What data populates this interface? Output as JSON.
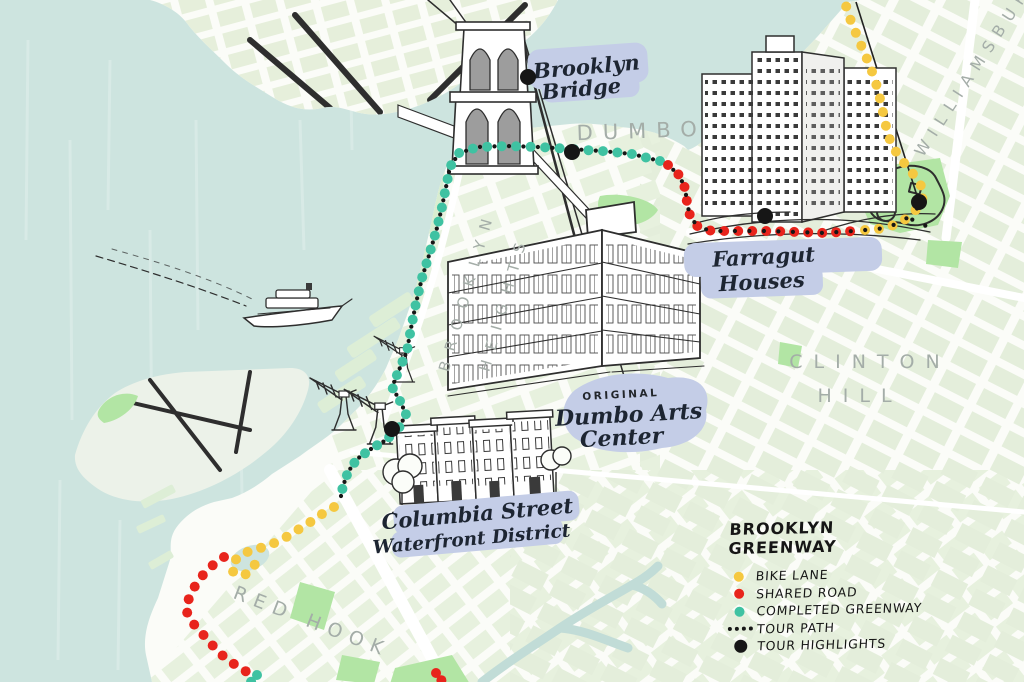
{
  "legend": {
    "title": "BROOKLYN GREENWAY",
    "items": [
      {
        "id": "bike-lane",
        "label": "BIKE LANE",
        "color": "#f5c840",
        "marker": "dot"
      },
      {
        "id": "shared-road",
        "label": "SHARED ROAD",
        "color": "#e8241c",
        "marker": "dot"
      },
      {
        "id": "completed-greenway",
        "label": "COMPLETED GREENWAY",
        "color": "#3fc2a2",
        "marker": "dot"
      },
      {
        "id": "tour-path",
        "label": "TOUR PATH",
        "color": "#161616",
        "marker": "small-dots"
      },
      {
        "id": "tour-highlights",
        "label": "TOUR HIGHLIGHTS",
        "color": "#161616",
        "marker": "large-dot"
      }
    ]
  },
  "labels": {
    "brooklyn_bridge": {
      "line1": "Brooklyn",
      "line2": "Bridge"
    },
    "farragut": {
      "line1": "Farragut",
      "line2": "Houses"
    },
    "dumbo_arts": {
      "kicker": "ORIGINAL",
      "line1": "Dumbo Arts",
      "line2": "Center"
    },
    "columbia": {
      "line1": "Columbia Street",
      "line2": "Waterfront District"
    },
    "neighborhoods": {
      "dumbo": "DUMBO",
      "brooklyn_heights_1": "BROOKLYN",
      "brooklyn_heights_2": "HEIGHTS",
      "clinton_hill_1": "CLINTON",
      "clinton_hill_2": "HILL",
      "red_hook": "RED HOOK",
      "williamsburg": "WILLIAMSBURG"
    }
  },
  "map": {
    "colors": {
      "water": "#cde4df",
      "land": "#fbfcf8",
      "block": "#e6efdb",
      "park": "#b2e5a4",
      "label_blob": "#c4cde7",
      "ink": "#2e2e2e",
      "gray_label": "#a4ada8",
      "canal": "#c1dcd7"
    },
    "routes": [
      {
        "id": "completed-greenway-main",
        "color_ref": "completed-greenway",
        "r": 5,
        "spacing": 14.5,
        "points": [
          [
            660,
            161
          ],
          [
            632,
            154
          ],
          [
            602,
            151
          ],
          [
            570,
            149
          ],
          [
            538,
            147
          ],
          [
            506,
            146
          ],
          [
            478,
            147
          ],
          [
            459,
            153
          ],
          [
            450,
            167
          ],
          [
            446,
            187
          ],
          [
            442,
            207
          ],
          [
            437,
            228
          ],
          [
            430,
            252
          ],
          [
            422,
            278
          ],
          [
            416,
            303
          ],
          [
            411,
            328
          ],
          [
            407,
            351
          ],
          [
            399,
            370
          ],
          [
            392,
            387
          ],
          [
            400,
            401
          ],
          [
            406,
            414
          ],
          [
            399,
            428
          ],
          [
            386,
            440
          ],
          [
            371,
            449
          ],
          [
            357,
            459
          ],
          [
            348,
            472
          ],
          [
            343,
            486
          ],
          [
            340,
            501
          ]
        ]
      },
      {
        "id": "bike-lane-columbia",
        "color_ref": "bike-lane",
        "r": 5,
        "spacing": 14,
        "points": [
          [
            334,
            507
          ],
          [
            322,
            514
          ],
          [
            309,
            523
          ],
          [
            296,
            531
          ],
          [
            283,
            539
          ],
          [
            270,
            545
          ],
          [
            257,
            549
          ],
          [
            244,
            553
          ],
          [
            234,
            561
          ],
          [
            232,
            571
          ],
          [
            241,
            576
          ],
          [
            251,
            572
          ],
          [
            256,
            562
          ],
          [
            250,
            553
          ]
        ]
      },
      {
        "id": "shared-road-redhook",
        "color_ref": "shared-road",
        "r": 5,
        "spacing": 14,
        "points": [
          [
            224,
            557
          ],
          [
            213,
            565
          ],
          [
            203,
            575
          ],
          [
            195,
            586
          ],
          [
            189,
            598
          ],
          [
            186,
            610
          ],
          [
            191,
            621
          ],
          [
            199,
            630
          ],
          [
            207,
            639
          ],
          [
            214,
            647
          ],
          [
            222,
            655
          ],
          [
            231,
            662
          ],
          [
            240,
            668
          ],
          [
            249,
            673
          ]
        ]
      },
      {
        "id": "completed-greenway-tail",
        "color_ref": "completed-greenway",
        "r": 5,
        "spacing": 9,
        "points": [
          [
            257,
            675
          ],
          [
            250,
            683
          ]
        ]
      },
      {
        "id": "shared-road-farragut",
        "color_ref": "shared-road",
        "r": 5,
        "spacing": 14,
        "points": [
          [
            668,
            165
          ],
          [
            679,
            175
          ],
          [
            685,
            188
          ],
          [
            687,
            202
          ],
          [
            690,
            216
          ],
          [
            698,
            227
          ],
          [
            712,
            231
          ],
          [
            740,
            231
          ],
          [
            768,
            231
          ],
          [
            796,
            232
          ],
          [
            824,
            233
          ],
          [
            853,
            231
          ]
        ]
      },
      {
        "id": "bike-lane-navy-yard",
        "color_ref": "bike-lane",
        "r": 5,
        "spacing": 14,
        "points": [
          [
            865,
            230
          ],
          [
            878,
            229
          ],
          [
            891,
            226
          ],
          [
            903,
            221
          ],
          [
            913,
            213
          ],
          [
            921,
            204
          ],
          [
            924,
            192
          ],
          [
            918,
            180
          ],
          [
            909,
            169
          ],
          [
            900,
            158
          ],
          [
            893,
            147
          ],
          [
            888,
            135
          ],
          [
            885,
            122
          ],
          [
            882,
            108
          ],
          [
            879,
            94
          ],
          [
            875,
            80
          ],
          [
            870,
            66
          ],
          [
            864,
            52
          ],
          [
            858,
            38
          ],
          [
            852,
            24
          ],
          [
            847,
            10
          ],
          [
            844,
            -3
          ]
        ]
      },
      {
        "id": "shared-road-gowanus",
        "color_ref": "shared-road",
        "r": 5,
        "spacing": 9,
        "points": [
          [
            436,
            673
          ],
          [
            442,
            681
          ]
        ]
      }
    ],
    "tour_path": {
      "r": 2.1,
      "spacing": 14.5,
      "offset": 7.2,
      "color": "#161616",
      "segments": [
        [
          [
            660,
            161
          ],
          [
            632,
            154
          ],
          [
            602,
            151
          ],
          [
            570,
            149
          ],
          [
            538,
            147
          ],
          [
            506,
            146
          ],
          [
            478,
            147
          ],
          [
            459,
            153
          ],
          [
            450,
            167
          ],
          [
            446,
            187
          ],
          [
            442,
            207
          ],
          [
            437,
            228
          ],
          [
            430,
            252
          ],
          [
            422,
            278
          ],
          [
            416,
            303
          ],
          [
            411,
            328
          ],
          [
            407,
            351
          ],
          [
            399,
            370
          ],
          [
            392,
            387
          ],
          [
            400,
            401
          ],
          [
            406,
            414
          ],
          [
            399,
            428
          ],
          [
            386,
            440
          ],
          [
            371,
            449
          ],
          [
            357,
            459
          ],
          [
            348,
            472
          ],
          [
            343,
            486
          ],
          [
            340,
            501
          ]
        ],
        [
          [
            668,
            165
          ],
          [
            679,
            175
          ],
          [
            685,
            188
          ],
          [
            687,
            202
          ],
          [
            690,
            216
          ],
          [
            698,
            227
          ],
          [
            712,
            231
          ],
          [
            740,
            231
          ],
          [
            768,
            231
          ],
          [
            796,
            232
          ],
          [
            824,
            233
          ],
          [
            853,
            231
          ],
          [
            865,
            230
          ],
          [
            878,
            229
          ],
          [
            891,
            226
          ],
          [
            903,
            221
          ],
          [
            913,
            213
          ],
          [
            921,
            204
          ]
        ],
        [
          [
            906,
            216
          ],
          [
            920,
            224
          ],
          [
            933,
            228
          ]
        ]
      ]
    },
    "highlights": {
      "r": 8,
      "color": "#161616",
      "points": [
        [
          528,
          77
        ],
        [
          572,
          152
        ],
        [
          765,
          216
        ],
        [
          919,
          202
        ],
        [
          392,
          429
        ]
      ]
    }
  }
}
